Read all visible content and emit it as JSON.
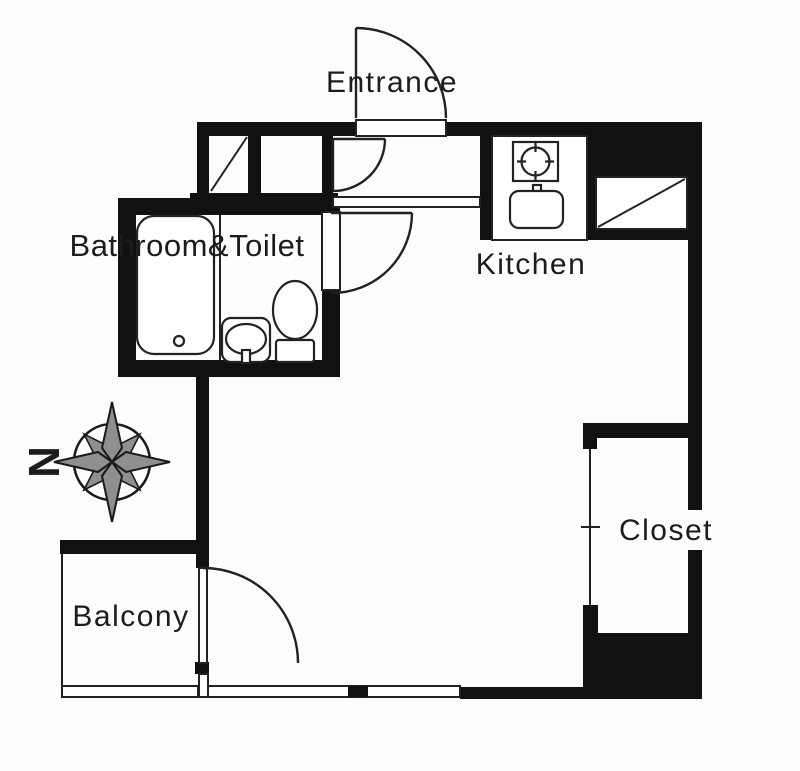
{
  "title": "Studio apartment floor plan",
  "rooms": {
    "entrance": {
      "label": "Entrance"
    },
    "kitchen": {
      "label": "Kitchen"
    },
    "bathroom_toilet": {
      "label": "Bathroom&Toilet"
    },
    "closet": {
      "label": "Closet"
    },
    "balcony": {
      "label": "Balcony"
    }
  },
  "compass": {
    "north_label": "N",
    "north_direction_on_screen": "left"
  },
  "fixtures": [
    "bathtub-icon",
    "washbasin-icon",
    "toilet-icon",
    "stove-icon",
    "kitchen-sink-icon",
    "shaft-diagonal-icon",
    "storage-diagonal-icon",
    "entrance-door-swing",
    "storage-door-swing",
    "bathroom-door-swing",
    "balcony-door-swing",
    "closet-sliding-door",
    "window-double-line",
    "compass-rose-icon"
  ],
  "colors": {
    "wall": "#111111",
    "line": "#222222",
    "text": "#1c1c1c",
    "compass": "#8f8f8f",
    "bg": "#fdfdfd"
  }
}
